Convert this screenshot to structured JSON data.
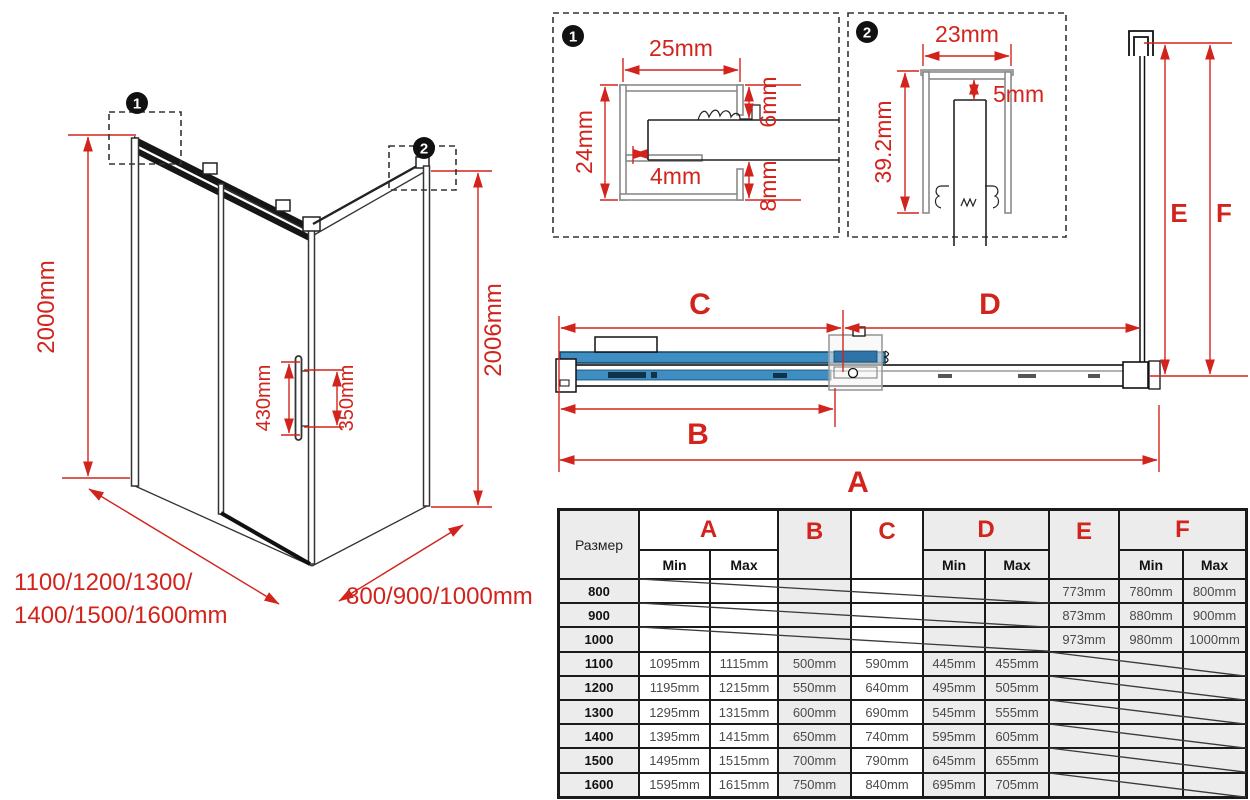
{
  "colors": {
    "accent_red": "#d2241d",
    "glass_blue": "#3e8ec4",
    "table_tint": "#ececec"
  },
  "iso_view": {
    "marker1": "1",
    "marker2": "2",
    "height_left": "2000mm",
    "height_right": "2006mm",
    "handle_length": "430mm",
    "handle_holes": "350mm",
    "width_label_line1": "1100/1200/1300/",
    "width_label_line2": "1400/1500/1600mm",
    "depth_label": "800/900/1000mm"
  },
  "detail_1": {
    "marker": "1",
    "width": "25mm",
    "height": "24mm",
    "inset": "4mm",
    "gap_top": "6mm",
    "gap_bottom": "8mm"
  },
  "detail_2": {
    "marker": "2",
    "width": "23mm",
    "height": "39.2mm",
    "gap": "5mm"
  },
  "plan_view": {
    "dim_a": "A",
    "dim_b": "B",
    "dim_c": "C",
    "dim_d": "D",
    "dim_e": "E",
    "dim_f": "F"
  },
  "table": {
    "size_label": "Размер",
    "col_a": "A",
    "col_b": "B",
    "col_c": "C",
    "col_d": "D",
    "col_e": "E",
    "col_f": "F",
    "min": "Min",
    "max": "Max",
    "rows": [
      {
        "size": "800",
        "a_min": "",
        "a_max": "",
        "b": "",
        "c": "",
        "d_min": "",
        "d_max": "",
        "e": "773mm",
        "f_min": "780mm",
        "f_max": "800mm",
        "empty": "left"
      },
      {
        "size": "900",
        "a_min": "",
        "a_max": "",
        "b": "",
        "c": "",
        "d_min": "",
        "d_max": "",
        "e": "873mm",
        "f_min": "880mm",
        "f_max": "900mm",
        "empty": "left"
      },
      {
        "size": "1000",
        "a_min": "",
        "a_max": "",
        "b": "",
        "c": "",
        "d_min": "",
        "d_max": "",
        "e": "973mm",
        "f_min": "980mm",
        "f_max": "1000mm",
        "empty": "left"
      },
      {
        "size": "1100",
        "a_min": "1095mm",
        "a_max": "1115mm",
        "b": "500mm",
        "c": "590mm",
        "d_min": "445mm",
        "d_max": "455mm",
        "e": "",
        "f_min": "",
        "f_max": "",
        "empty": "right"
      },
      {
        "size": "1200",
        "a_min": "1195mm",
        "a_max": "1215mm",
        "b": "550mm",
        "c": "640mm",
        "d_min": "495mm",
        "d_max": "505mm",
        "e": "",
        "f_min": "",
        "f_max": "",
        "empty": "right"
      },
      {
        "size": "1300",
        "a_min": "1295mm",
        "a_max": "1315mm",
        "b": "600mm",
        "c": "690mm",
        "d_min": "545mm",
        "d_max": "555mm",
        "e": "",
        "f_min": "",
        "f_max": "",
        "empty": "right"
      },
      {
        "size": "1400",
        "a_min": "1395mm",
        "a_max": "1415mm",
        "b": "650mm",
        "c": "740mm",
        "d_min": "595mm",
        "d_max": "605mm",
        "e": "",
        "f_min": "",
        "f_max": "",
        "empty": "right"
      },
      {
        "size": "1500",
        "a_min": "1495mm",
        "a_max": "1515mm",
        "b": "700mm",
        "c": "790mm",
        "d_min": "645mm",
        "d_max": "655mm",
        "e": "",
        "f_min": "",
        "f_max": "",
        "empty": "right"
      },
      {
        "size": "1600",
        "a_min": "1595mm",
        "a_max": "1615mm",
        "b": "750mm",
        "c": "840mm",
        "d_min": "695mm",
        "d_max": "705mm",
        "e": "",
        "f_min": "",
        "f_max": "",
        "empty": "right"
      }
    ]
  }
}
